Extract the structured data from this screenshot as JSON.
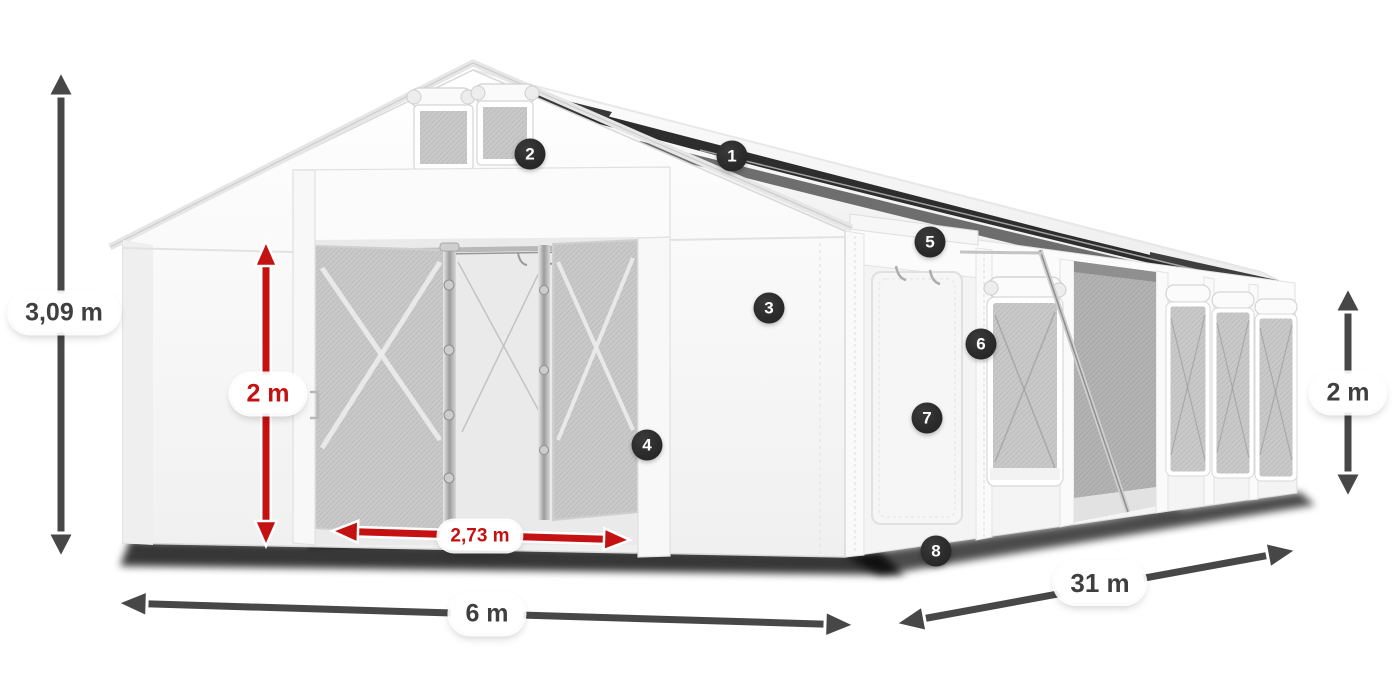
{
  "diagram": {
    "title": "Tent dimensions diagram",
    "labels": {
      "total_height": "3,09 m",
      "entrance_height": "2 m",
      "entrance_width": "2,73 m",
      "width": "6 m",
      "length": "31 m",
      "side_height": "2 m"
    },
    "callouts": [
      "1",
      "2",
      "3",
      "4",
      "5",
      "6",
      "7",
      "8"
    ],
    "colors": {
      "dimension_arrow_gray": "#474747",
      "dimension_arrow_red": "#c41111",
      "callout_background": "#2b2b2b",
      "label_text": "#3f3f3f"
    }
  }
}
